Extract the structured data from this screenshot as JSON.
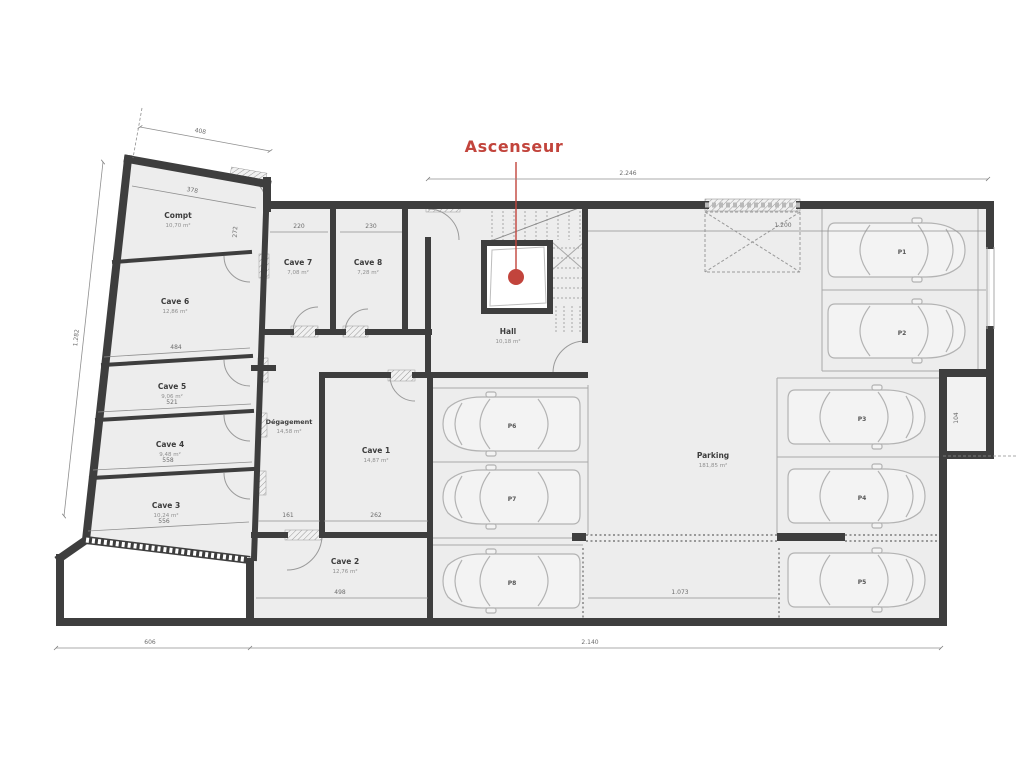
{
  "plan": {
    "type": "basement-floor-plan",
    "callout": {
      "label": "Ascenseur"
    }
  },
  "colors": {
    "accent_red": "#c2443c",
    "wall": "#3e3e3e",
    "room_fill": "#ededed",
    "line_gray": "#9a9a9a",
    "background": "#ffffff"
  },
  "rooms": [
    {
      "name": "Compt",
      "area": "10,70 m²"
    },
    {
      "name": "Cave 6",
      "area": "12,86 m²"
    },
    {
      "name": "Cave 5",
      "area": "9,06 m²"
    },
    {
      "name": "Cave 4",
      "area": "9,48 m²"
    },
    {
      "name": "Cave 3",
      "area": "10,24 m²"
    },
    {
      "name": "Cave 7",
      "area": "7,08 m²"
    },
    {
      "name": "Cave 8",
      "area": "7,28 m²"
    },
    {
      "name": "Hall",
      "area": "10,18 m²"
    },
    {
      "name": "Dégagement",
      "area": "14,58 m²"
    },
    {
      "name": "Cave 1",
      "area": "14,87 m²"
    },
    {
      "name": "Cave 2",
      "area": "12,76 m²"
    }
  ],
  "parking": {
    "label": "Parking",
    "area": "181,85 m²",
    "spots": [
      "P1",
      "P2",
      "P3",
      "P4",
      "P5",
      "P6",
      "P7",
      "P8"
    ]
  },
  "dims": {
    "top": "2.246",
    "opening": "1.200",
    "top_left": "408",
    "compt_top": "378",
    "compt_side": "272",
    "left": "1.282",
    "bottom_left": "606",
    "bottom": "2.140",
    "ramp": "1.073",
    "cave2": "498",
    "degagement": "161",
    "cave1": "262",
    "cave7": "220",
    "cave8": "230",
    "cave6": "484",
    "cave5": "521",
    "cave4": "558",
    "cave3": "556",
    "notch": "104"
  }
}
